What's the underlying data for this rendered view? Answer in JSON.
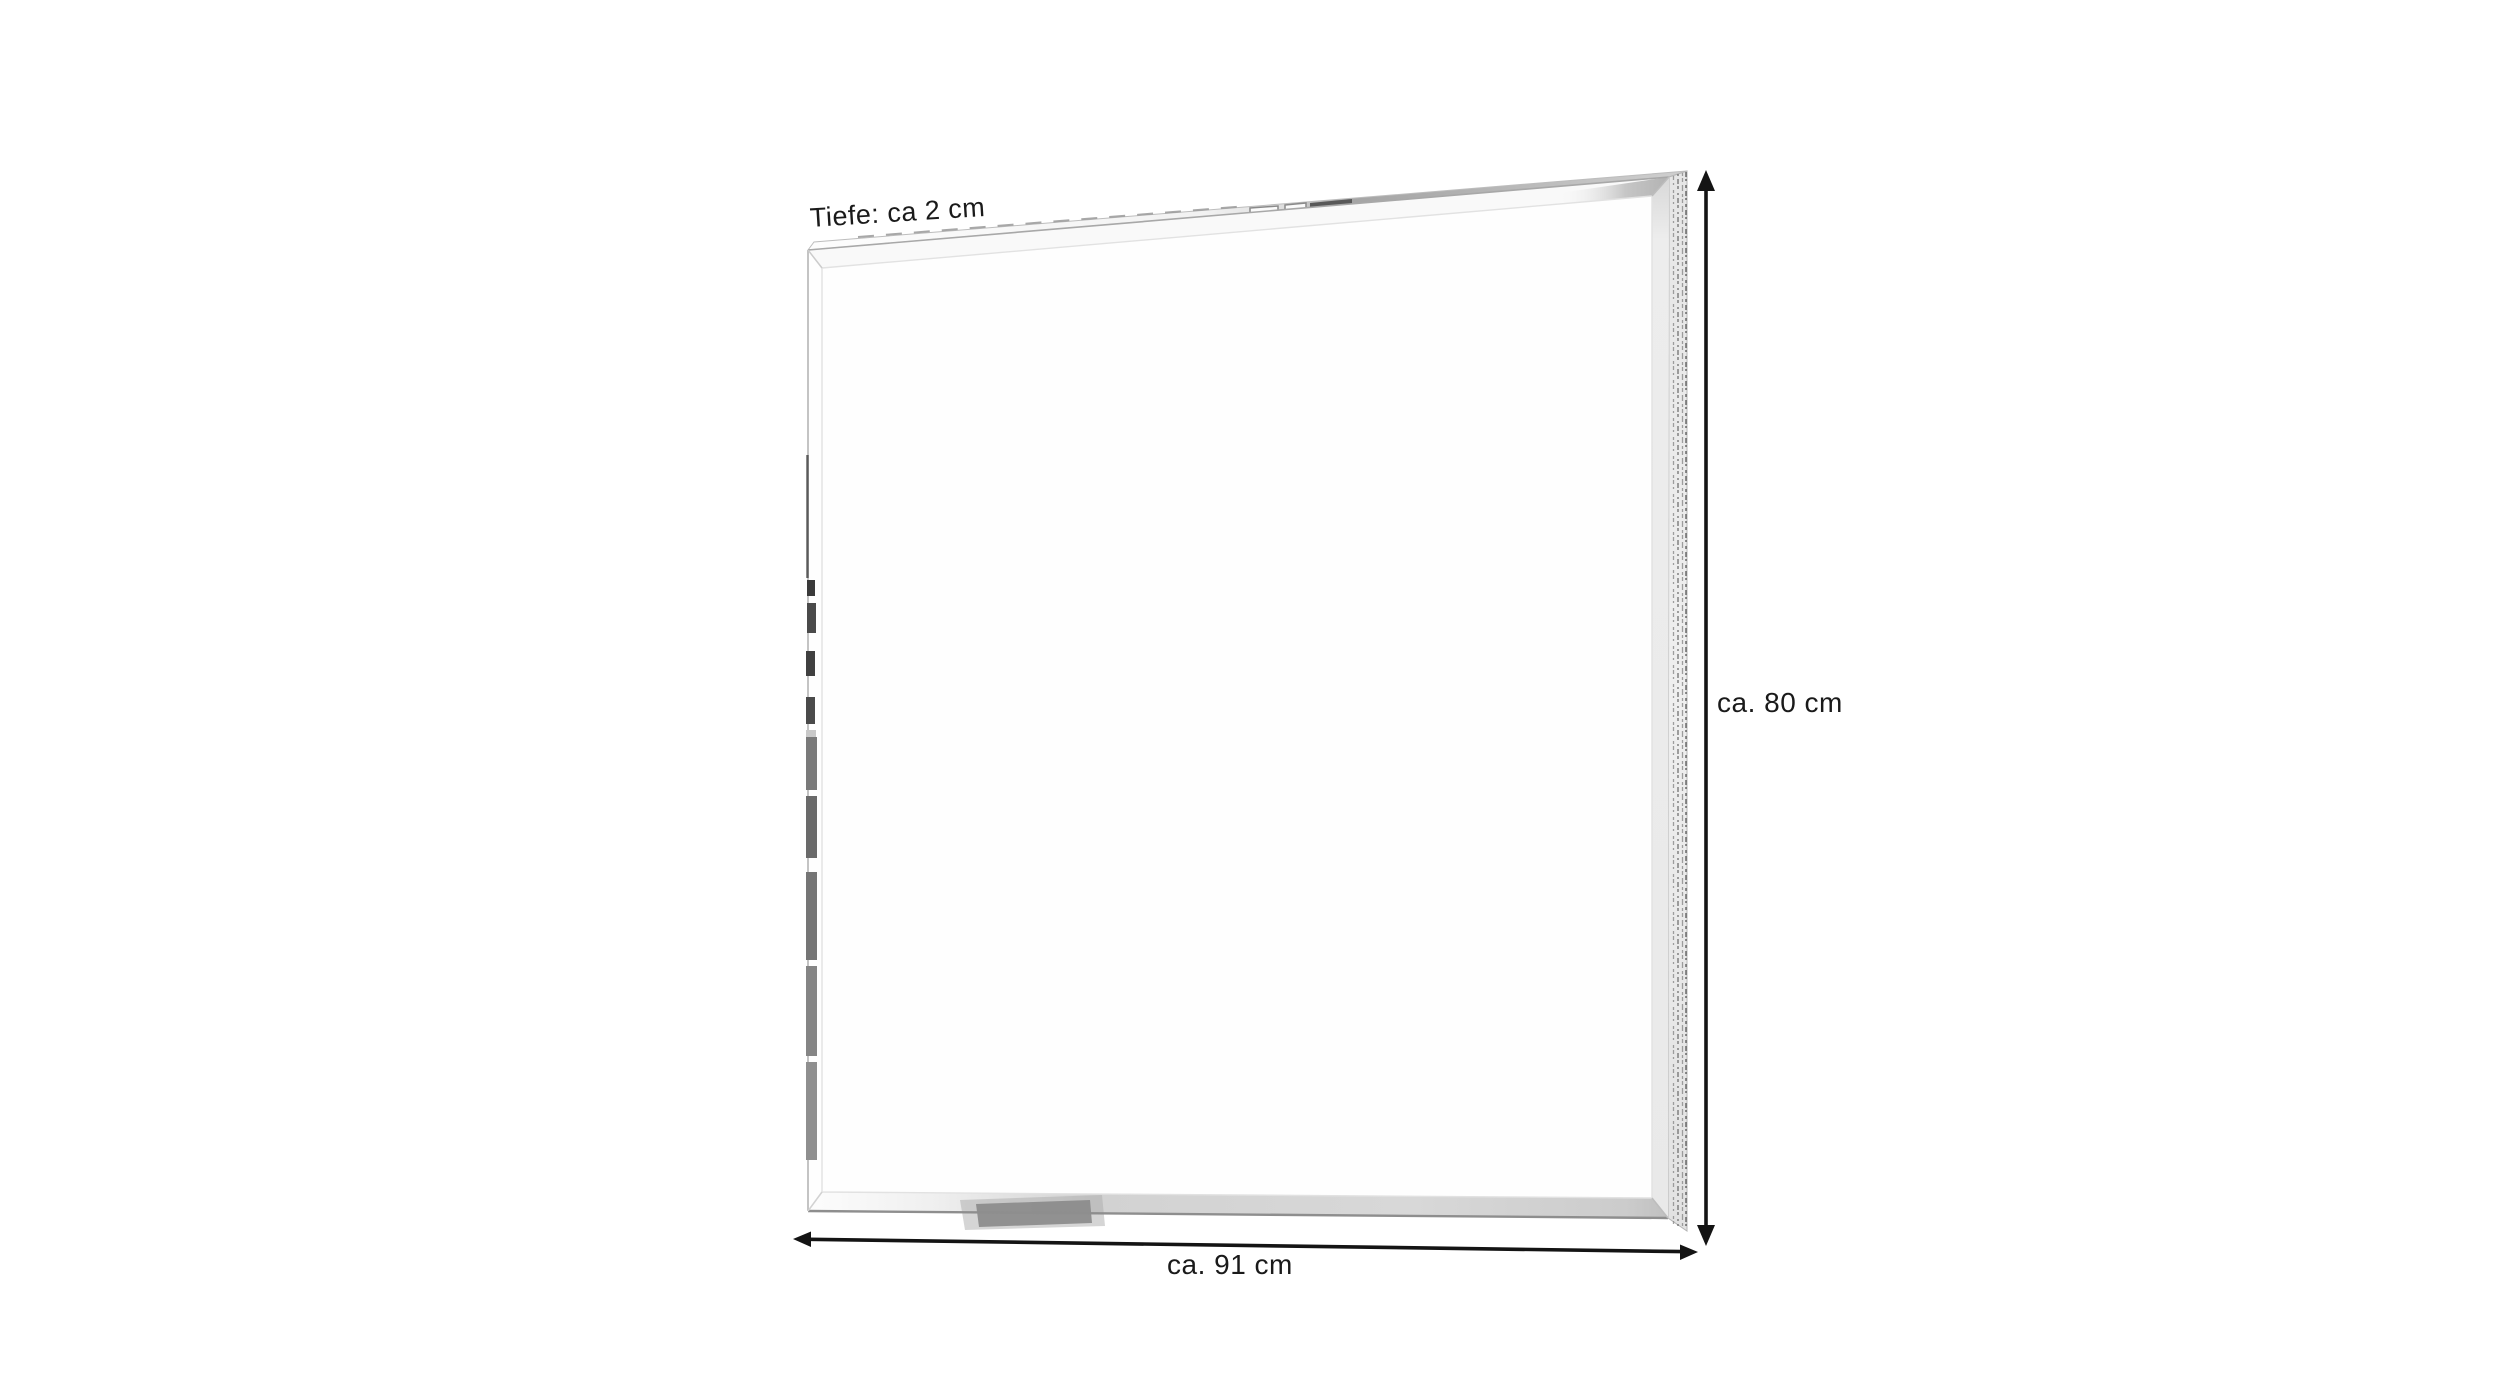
{
  "diagram": {
    "depth_label": "Tiefe: ca 2 cm",
    "height_label": "ca. 80 cm",
    "width_label": "ca. 91 cm"
  },
  "colors": {
    "background": "#ffffff",
    "annotation_text": "#1a1a1a",
    "dimension_line": "#141414",
    "mirror_outline": "#b8b8b8",
    "frame_side_light": "#ededed",
    "frame_top_dark_segment": "#585858",
    "bottom_bevel_shadow": "#8a8a8a",
    "left_edge_reflection": "#6a6a6a"
  }
}
